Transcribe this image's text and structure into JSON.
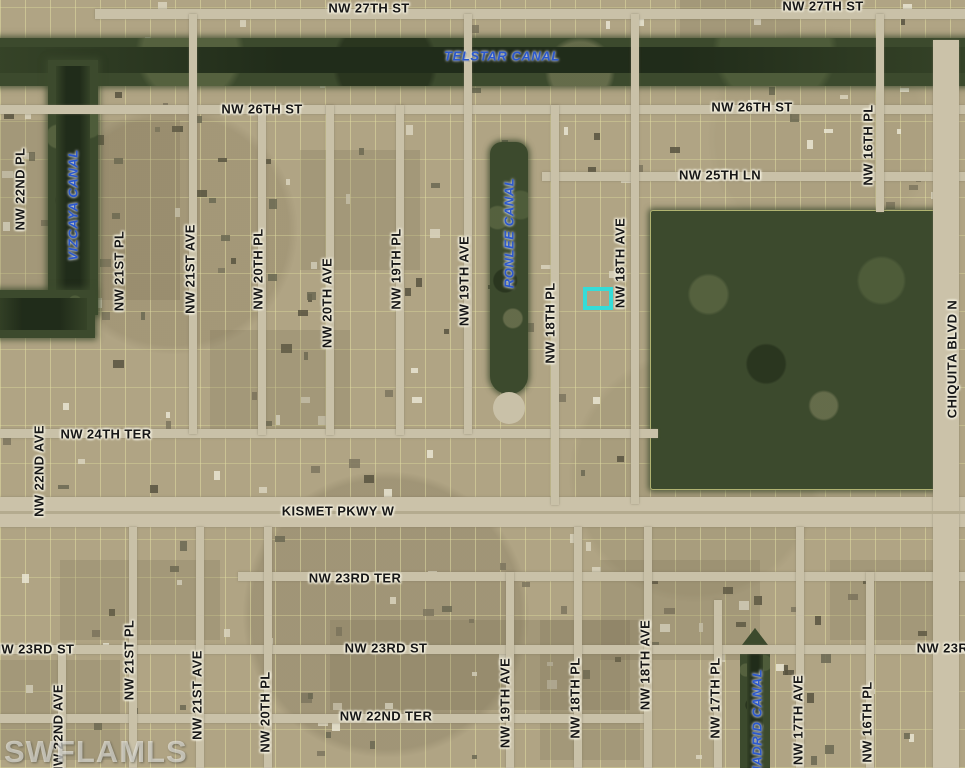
{
  "map": {
    "watermark": "SWFLAMLS",
    "highlight": {
      "name": "subject-property-highlight",
      "color": "#35dcd8",
      "x": 583,
      "y": 287,
      "w": 30,
      "h": 23,
      "stroke": 4
    },
    "colors": {
      "street_label": "#171717",
      "canal_label": "#2b58cd",
      "terrain": "#b0a484",
      "vegetation": "#3c4a2d",
      "road": "#c9c1a8",
      "highlight": "#35dcd8"
    },
    "labels": [
      {
        "text": "NW 27TH ST",
        "x": 369,
        "y": 8,
        "orient": "h",
        "kind": "street"
      },
      {
        "text": "NW 27TH ST",
        "x": 823,
        "y": 6,
        "orient": "h",
        "kind": "street"
      },
      {
        "text": "TELSTAR CANAL",
        "x": 502,
        "y": 56,
        "orient": "h",
        "kind": "canal"
      },
      {
        "text": "NW 26TH ST",
        "x": 262,
        "y": 109,
        "orient": "h",
        "kind": "street"
      },
      {
        "text": "NW 26TH ST",
        "x": 752,
        "y": 107,
        "orient": "h",
        "kind": "street"
      },
      {
        "text": "NW 25TH LN",
        "x": 720,
        "y": 175,
        "orient": "h",
        "kind": "street"
      },
      {
        "text": "NW 24TH TER",
        "x": 106,
        "y": 434,
        "orient": "h",
        "kind": "street"
      },
      {
        "text": "KISMET PKWY W",
        "x": 338,
        "y": 511,
        "orient": "h",
        "kind": "street"
      },
      {
        "text": "NW 23RD TER",
        "x": 355,
        "y": 578,
        "orient": "h",
        "kind": "street"
      },
      {
        "text": "NW 23RD ST",
        "x": 33,
        "y": 649,
        "orient": "h",
        "kind": "street"
      },
      {
        "text": "NW 23RD ST",
        "x": 386,
        "y": 648,
        "orient": "h",
        "kind": "street"
      },
      {
        "text": "NW 22ND TER",
        "x": 386,
        "y": 716,
        "orient": "h",
        "kind": "street"
      },
      {
        "text": "NW 23RD ST",
        "x": 958,
        "y": 648,
        "orient": "h",
        "kind": "street"
      },
      {
        "text": "NW 22ND PL",
        "x": 20,
        "y": 189,
        "orient": "v",
        "kind": "street"
      },
      {
        "text": "VIZCAYA CANAL",
        "x": 73,
        "y": 205,
        "orient": "v",
        "kind": "canal"
      },
      {
        "text": "NW 21ST PL",
        "x": 119,
        "y": 271,
        "orient": "v",
        "kind": "street"
      },
      {
        "text": "NW 21ST AVE",
        "x": 190,
        "y": 269,
        "orient": "v",
        "kind": "street"
      },
      {
        "text": "NW 20TH PL",
        "x": 258,
        "y": 269,
        "orient": "v",
        "kind": "street"
      },
      {
        "text": "NW 20TH AVE",
        "x": 327,
        "y": 303,
        "orient": "v",
        "kind": "street"
      },
      {
        "text": "NW 19TH PL",
        "x": 396,
        "y": 269,
        "orient": "v",
        "kind": "street"
      },
      {
        "text": "NW 19TH AVE",
        "x": 464,
        "y": 281,
        "orient": "v",
        "kind": "street"
      },
      {
        "text": "RONLEE CANAL",
        "x": 509,
        "y": 233,
        "orient": "v",
        "kind": "canal"
      },
      {
        "text": "NW 18TH PL",
        "x": 550,
        "y": 323,
        "orient": "v",
        "kind": "street"
      },
      {
        "text": "NW 18TH AVE",
        "x": 620,
        "y": 263,
        "orient": "v",
        "kind": "street"
      },
      {
        "text": "NW 16TH PL",
        "x": 868,
        "y": 145,
        "orient": "v",
        "kind": "street"
      },
      {
        "text": "CHIQUITA BLVD N",
        "x": 952,
        "y": 359,
        "orient": "v",
        "kind": "street"
      },
      {
        "text": "NW 22ND AVE",
        "x": 39,
        "y": 471,
        "orient": "v",
        "kind": "street"
      },
      {
        "text": "NW 22ND AVE",
        "x": 58,
        "y": 730,
        "orient": "v",
        "kind": "street"
      },
      {
        "text": "NW 21ST PL",
        "x": 129,
        "y": 660,
        "orient": "v",
        "kind": "street"
      },
      {
        "text": "NW 21ST AVE",
        "x": 197,
        "y": 695,
        "orient": "v",
        "kind": "street"
      },
      {
        "text": "NW 20TH PL",
        "x": 265,
        "y": 712,
        "orient": "v",
        "kind": "street"
      },
      {
        "text": "NW 19TH AVE",
        "x": 505,
        "y": 703,
        "orient": "v",
        "kind": "street"
      },
      {
        "text": "NW 18TH PL",
        "x": 575,
        "y": 698,
        "orient": "v",
        "kind": "street"
      },
      {
        "text": "NW 18TH AVE",
        "x": 645,
        "y": 665,
        "orient": "v",
        "kind": "street"
      },
      {
        "text": "NW 17TH PL",
        "x": 715,
        "y": 698,
        "orient": "v",
        "kind": "street"
      },
      {
        "text": "MADRID CANAL",
        "x": 757,
        "y": 723,
        "orient": "v",
        "kind": "canal"
      },
      {
        "text": "NW 17TH AVE",
        "x": 798,
        "y": 720,
        "orient": "v",
        "kind": "street"
      },
      {
        "text": "NW 16TH PL",
        "x": 867,
        "y": 722,
        "orient": "v",
        "kind": "street"
      }
    ]
  }
}
